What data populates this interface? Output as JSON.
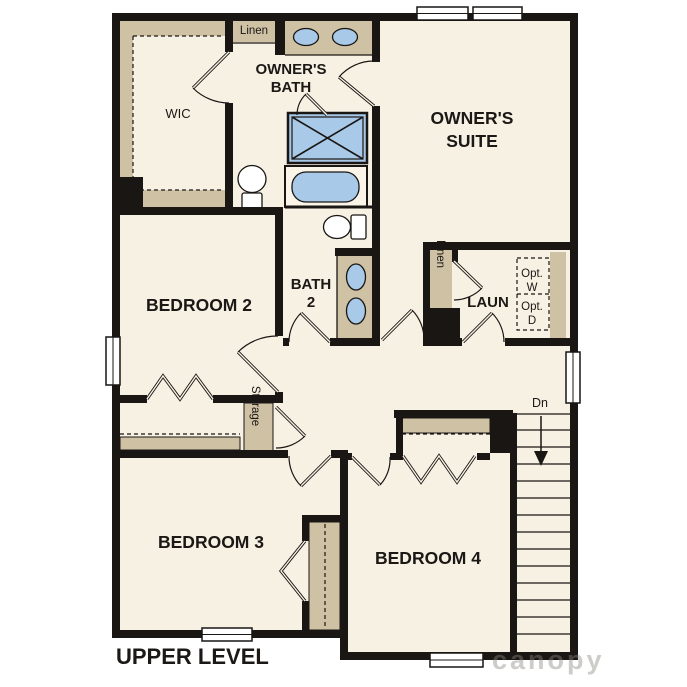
{
  "plan": {
    "title": "UPPER LEVEL",
    "watermark": "canopy",
    "labels": {
      "wic": "WIC",
      "owners_bath_1": "OWNER'S",
      "owners_bath_2": "BATH",
      "owners_suite_1": "OWNER'S",
      "owners_suite_2": "SUITE",
      "linen_bath": "Linen",
      "linen_hall": "Linen",
      "bedroom2": "BEDROOM 2",
      "bath2_1": "BATH",
      "bath2_2": "2",
      "laundry": "LAUN",
      "opt_w_1": "Opt.",
      "opt_w_2": "W",
      "opt_d_1": "Opt.",
      "opt_d_2": "D",
      "storage": "Storage",
      "bedroom3": "BEDROOM 3",
      "bedroom4": "BEDROOM 4",
      "stairs_down": "Dn"
    },
    "colors": {
      "floor": "#f7f1e4",
      "wall": "#191613",
      "casework": "#cfc1a4",
      "fixture_blue": "#a9c9e9",
      "optional_fill": "#dde4e9",
      "text": "#1b1815",
      "watermark": "#8d8780"
    }
  }
}
